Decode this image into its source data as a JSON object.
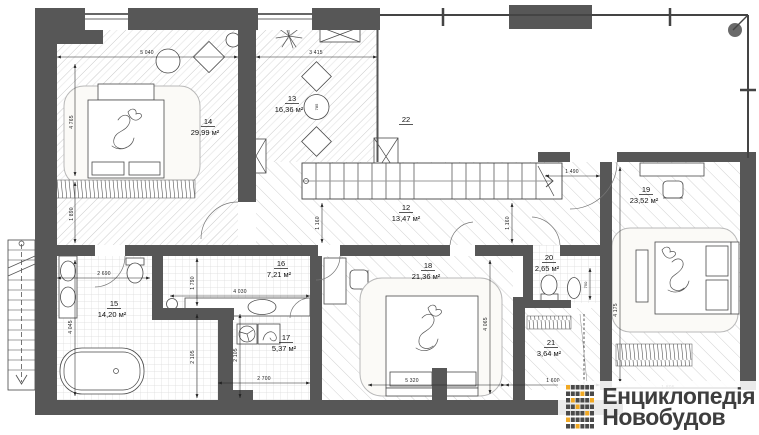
{
  "plan": {
    "rooms": [
      {
        "id": "12",
        "area": "13,47 м²"
      },
      {
        "id": "13",
        "area": "16,36 м²"
      },
      {
        "id": "14",
        "area": "29,99 м²"
      },
      {
        "id": "15",
        "area": "14,20 м²"
      },
      {
        "id": "16",
        "area": "7,21 м²"
      },
      {
        "id": "17",
        "area": "5,37 м²"
      },
      {
        "id": "18",
        "area": "21,36 м²"
      },
      {
        "id": "19",
        "area": "23,52 м²"
      },
      {
        "id": "20",
        "area": "2,65 м²"
      },
      {
        "id": "21",
        "area": "3,64 м²"
      },
      {
        "id": "22",
        "area": ""
      }
    ],
    "dims": {
      "w5040": "5 040",
      "w3415": "3 415",
      "w1490": "1 490",
      "w2690": "2 690",
      "w4030": "4 030",
      "w2700": "2 700",
      "w5320": "5 320",
      "w1600": "1 600",
      "w1805": "1 805",
      "h4765": "4 765",
      "h1890": "1 890",
      "h1790": "1 790",
      "h2105a": "2 105",
      "h2105b": "2 105",
      "h4045": "4 045",
      "h1160a": "1 160",
      "h1160b": "1 160",
      "h4065": "4 065",
      "h4175": "4 175",
      "h750": "750",
      "d785": "785"
    },
    "colors": {
      "wall": "#575757",
      "dim": "#222222",
      "accent": "#f0a823",
      "logo_text": "#3e3e3e"
    }
  },
  "logo": {
    "line1": "Енциклопедія",
    "line2": "Новобудов"
  }
}
